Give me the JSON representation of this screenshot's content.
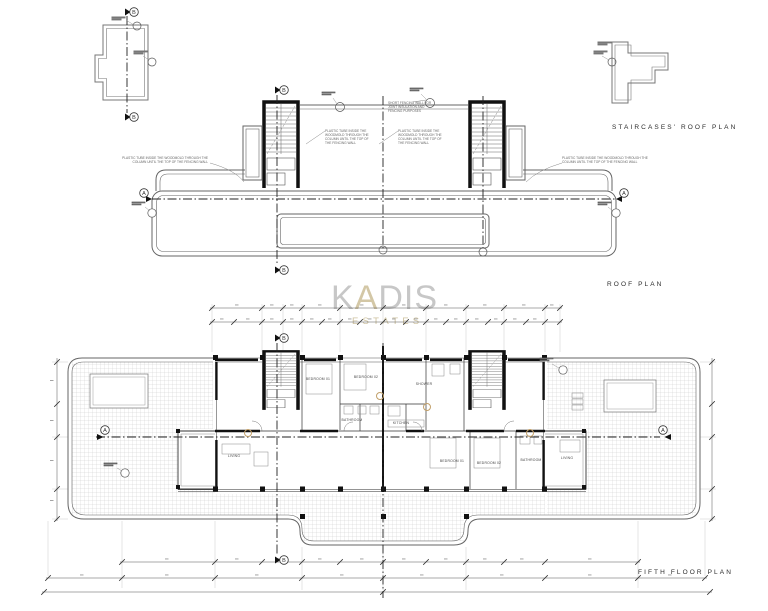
{
  "sheet": {
    "background": "#ffffff",
    "line_color": "#3a3a3a",
    "wall_color": "#111111",
    "hatch_color": "#c9c9c9",
    "accent_tan": "#c2a06a",
    "watermark_gray": "#c7c7c7",
    "watermark_beige": "#d3c7a6"
  },
  "titles": {
    "staircases_roof_plan": "STAIRCASES' ROOF PLAN",
    "roof_plan": "ROOF PLAN",
    "fifth_floor_plan": "FIFTH FLOOR PLAN"
  },
  "watermark": {
    "brand_k": "K",
    "brand_a": "A",
    "brand_rest": "DIS",
    "subtitle": "ESTATES"
  },
  "markers": {
    "section_a": "A",
    "section_b": "B"
  },
  "annotations": {
    "plastic_tube": "PLASTIC TUBE INSIDE THE WOODMOLD THROUGH THE COLUMN UNTIL THE TOP OF THE FENCING WALL",
    "short_fencing_wall": "SHORT FENCING WALL FOR JOINT INSULATION AND FENCING PURPOSES"
  },
  "rooms": {
    "left_bedroom_1": "BEDROOM 01",
    "left_bedroom_2": "BEDROOM 02",
    "left_bathroom": "BATHROOM",
    "left_living": "LIVING",
    "shower": "SHOWER",
    "kitchen": "KITCHEN",
    "right_bedroom_1": "BEDROOM 01",
    "right_bedroom_2": "BEDROOM 02",
    "right_bathroom": "BATHROOM",
    "right_living": "LIVING"
  }
}
